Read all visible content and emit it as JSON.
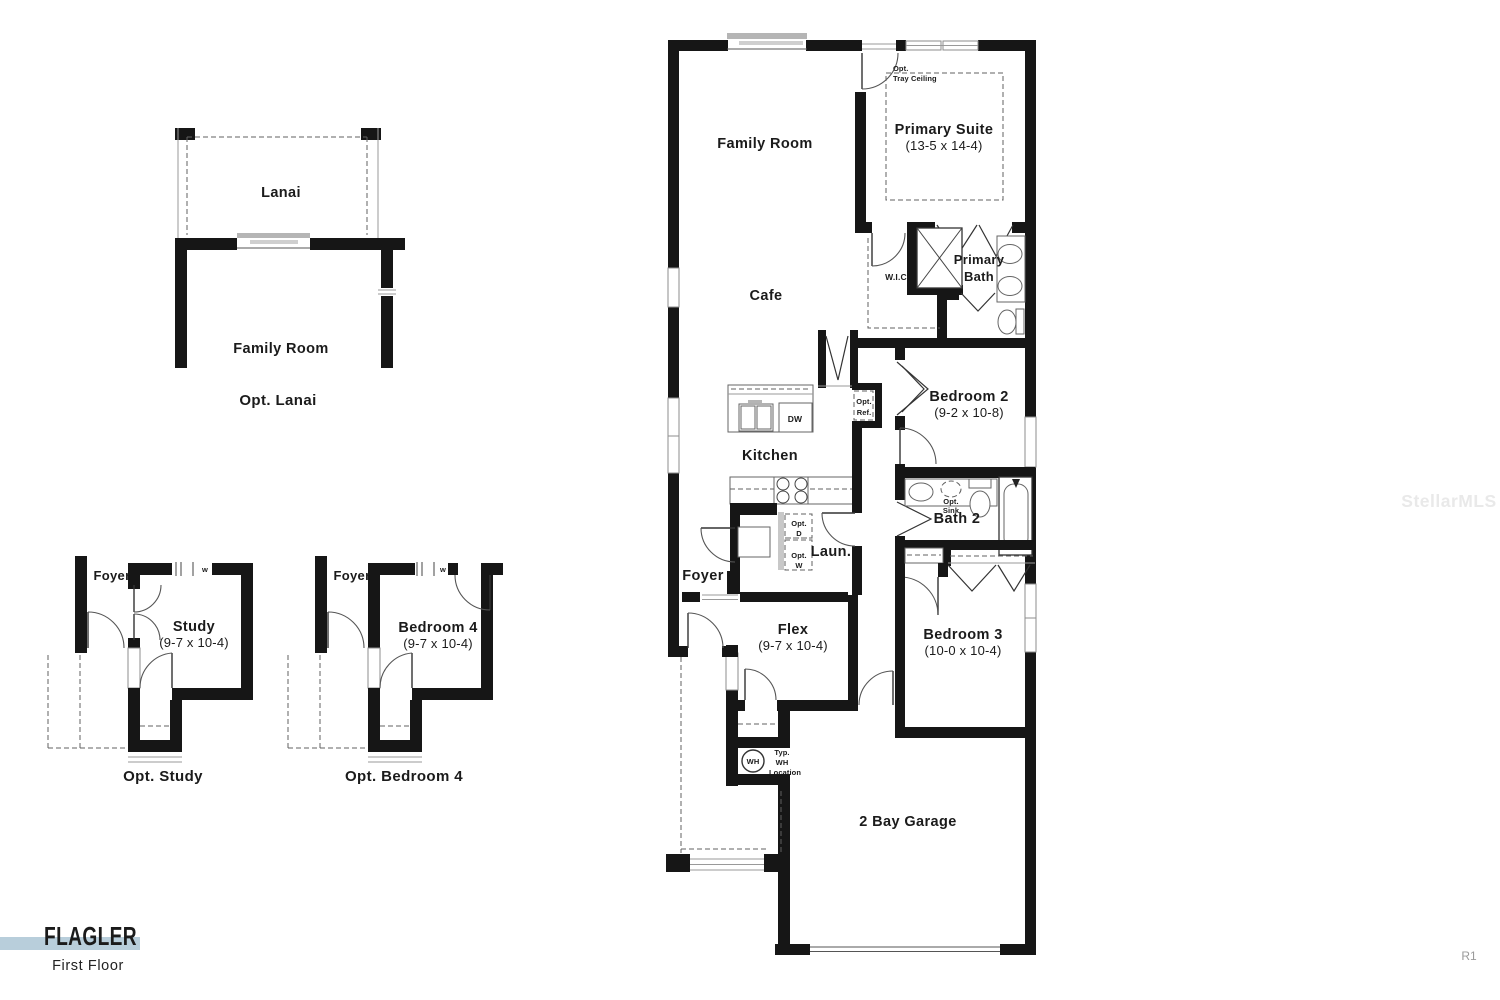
{
  "page": {
    "watermark": "StellarMLS",
    "revision": "R1"
  },
  "title_block": {
    "plan_name": "FLAGLER",
    "floor_label": "First Floor",
    "accent_color": "#b8cedb"
  },
  "opt_lanai": {
    "lanai": "Lanai",
    "family_room": "Family Room",
    "caption": "Opt. Lanai"
  },
  "opt_study": {
    "foyer": "Foyer",
    "washer": "w",
    "room": "Study",
    "dims": "(9-7 x 10-4)",
    "caption": "Opt. Study"
  },
  "opt_bedroom4": {
    "foyer": "Foyer",
    "washer": "w",
    "room": "Bedroom 4",
    "dims": "(9-7 x 10-4)",
    "caption": "Opt. Bedroom 4"
  },
  "plan": {
    "family_room": "Family Room",
    "tray_opt": "Opt.",
    "tray_ceiling": "Tray Ceiling",
    "primary_suite": "Primary Suite",
    "primary_suite_dims": "(13-5 x 14-4)",
    "cafe": "Cafe",
    "wic": "W.I.C",
    "primary_bath_1": "Primary",
    "primary_bath_2": "Bath",
    "kitchen": "Kitchen",
    "dw": "DW",
    "opt_ref_1": "Opt.",
    "opt_ref_2": "Ref.",
    "bedroom2": "Bedroom 2",
    "bedroom2_dims": "(9-2 x 10-8)",
    "opt_sink_1": "Opt.",
    "opt_sink_2": "Sink",
    "bath2": "Bath 2",
    "laundry": "Laun.",
    "opt_d_1": "Opt.",
    "opt_d_2": "D",
    "opt_w_1": "Opt.",
    "opt_w_2": "W",
    "foyer": "Foyer",
    "flex": "Flex",
    "flex_dims": "(9-7 x 10-4)",
    "bedroom3": "Bedroom 3",
    "bedroom3_dims": "(10-0 x 10-4)",
    "wh": "WH",
    "wh_note_1": "Typ.",
    "wh_note_2": "WH",
    "wh_note_3": "Location",
    "garage": "2 Bay Garage"
  }
}
